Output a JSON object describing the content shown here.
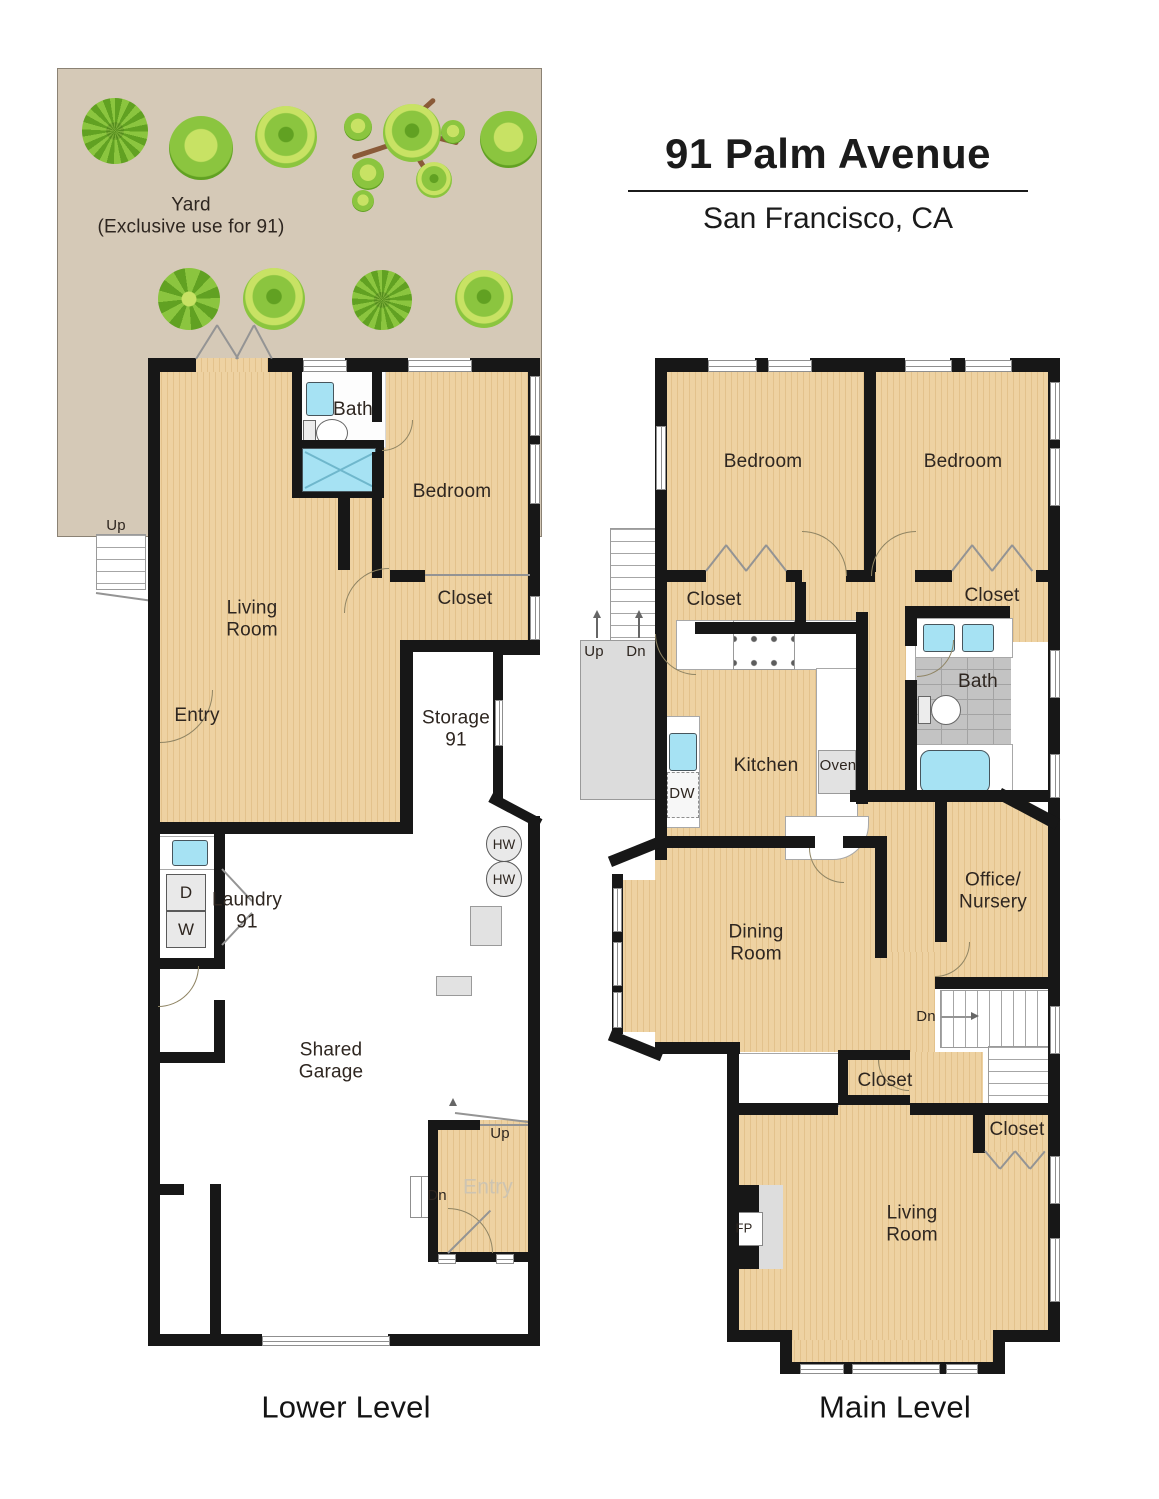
{
  "title": {
    "address": "91 Palm Avenue",
    "city": "San Francisco, CA"
  },
  "yard": {
    "label": "Yard\n(Exclusive use for 91)"
  },
  "lower_level": {
    "caption": "Lower Level",
    "labels": {
      "bath": "Bath",
      "bedroom": "Bedroom",
      "closet": "Closet",
      "living_room": "Living\nRoom",
      "entry": "Entry",
      "storage": "Storage\n91",
      "laundry": "Laundry\n91",
      "shared_garage": "Shared\nGarage",
      "garage_entry": "Entry"
    },
    "markers": {
      "up_yard": "Up",
      "up_entry": "Up",
      "dn_entry": "Dn",
      "dryer": "D",
      "washer": "W",
      "water_heater": "HW"
    }
  },
  "main_level": {
    "caption": "Main Level",
    "labels": {
      "bedroom_left": "Bedroom",
      "bedroom_right": "Bedroom",
      "closet_left": "Closet",
      "closet_right": "Closet",
      "closet_hall": "Closet",
      "closet_living": "Closet",
      "bath": "Bath",
      "kitchen": "Kitchen",
      "office": "Office/\nNursery",
      "dining_room": "Dining\nRoom",
      "living_room": "Living\nRoom"
    },
    "markers": {
      "up": "Up",
      "dn": "Dn",
      "dn_stairs": "Dn",
      "oven": "Oven",
      "dishwasher": "DW",
      "fireplace": "FP"
    }
  },
  "colors": {
    "wall": "#171717",
    "floor": "#eed2a2",
    "floor_stripe": "#e3c28c",
    "yard": "#d5c9b7",
    "water": "#a6e2f3",
    "tile": "#c3c3c3",
    "landing": "#dcdcdc",
    "tree_light": "#c8e264",
    "tree_mid": "#8bc53f",
    "tree_dark": "#61a122",
    "trunk": "#8a5a38"
  }
}
